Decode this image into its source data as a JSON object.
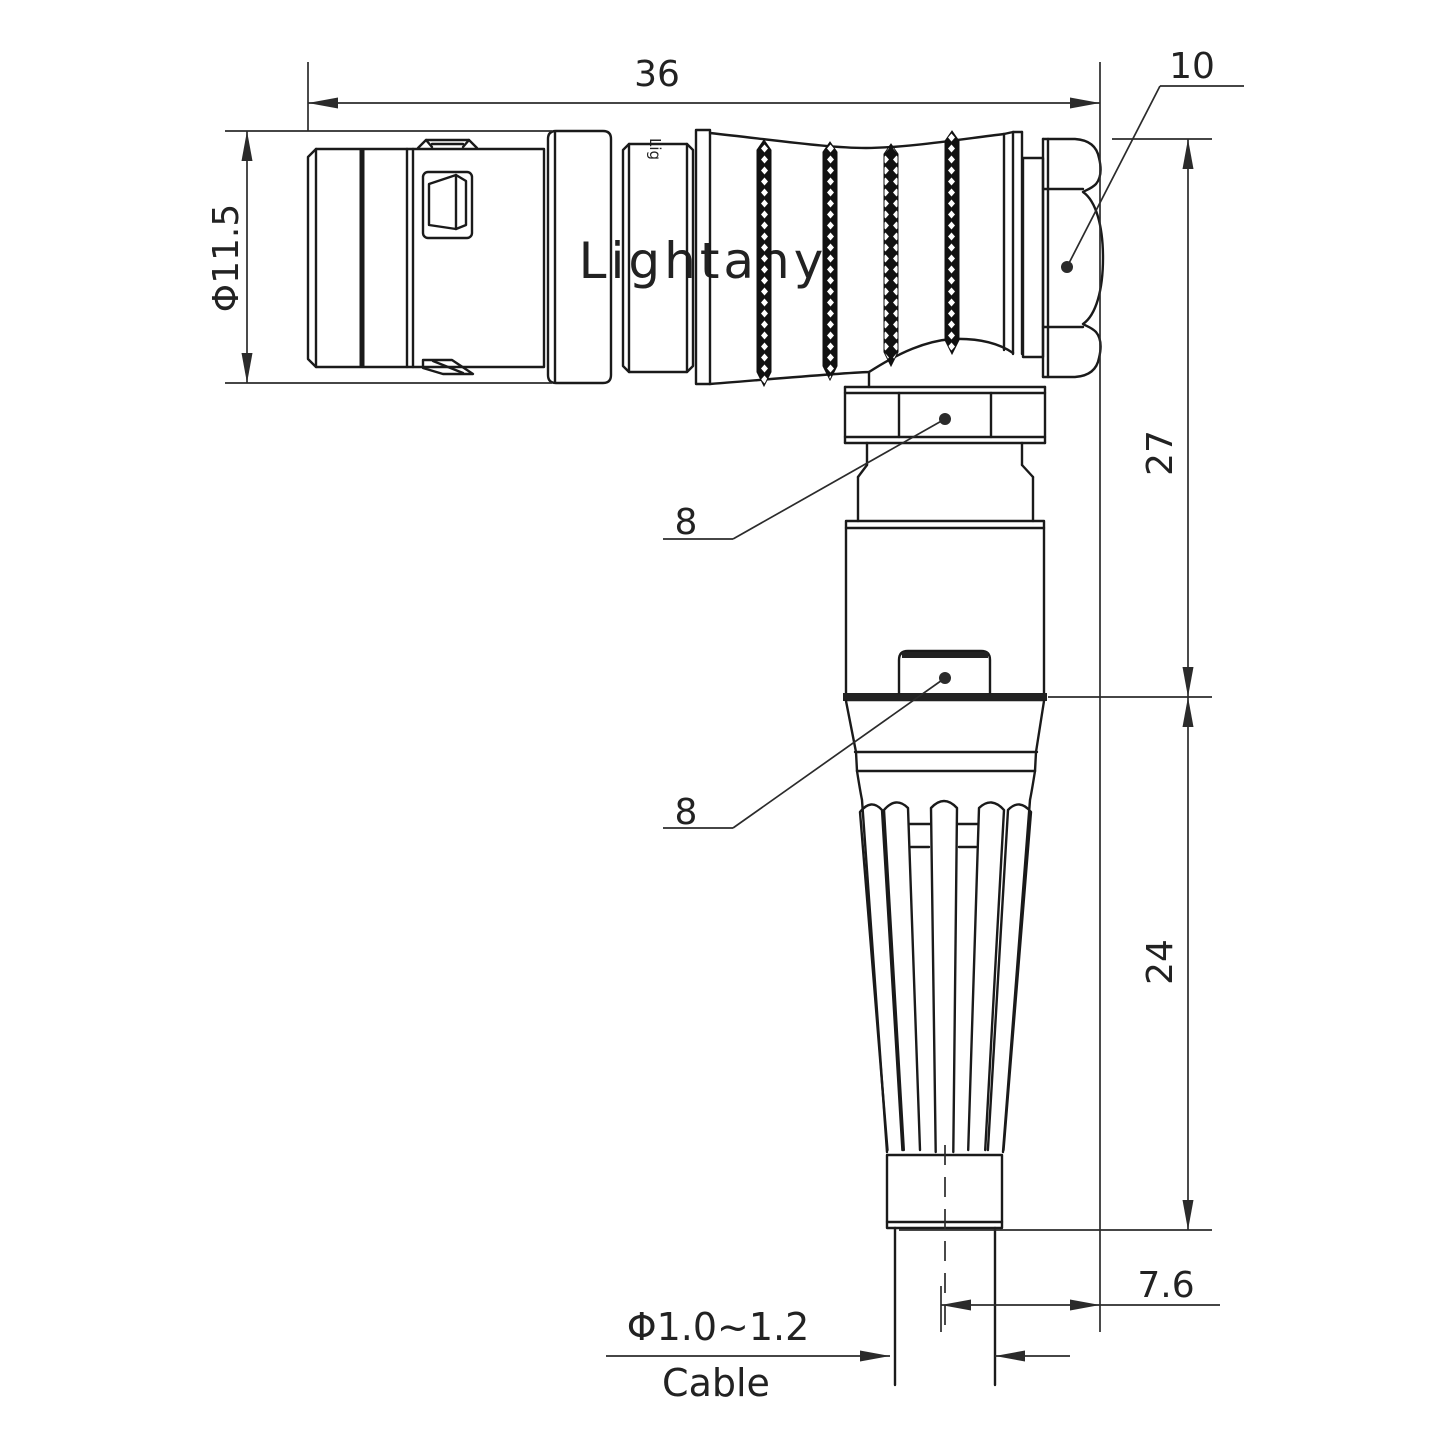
{
  "title": "right-angle-connector-technical-drawing",
  "watermark": {
    "text": "Lightany",
    "small_text": "Lig",
    "color": "#f3bdb8"
  },
  "dimensions": {
    "overall_length": "36",
    "nut_flat": "10",
    "shell_diameter": "Φ11.5",
    "upper_height": "27",
    "elbow_hex": "8",
    "body_hex": "8",
    "lower_height": "24",
    "cable_offset": "7.6",
    "cable_diameter": "Φ1.0~1.2",
    "cable_word": "Cable"
  },
  "colors": {
    "line": "#1a1a1a",
    "dimension": "#2b2b2b",
    "watermark": "#f3bdb8",
    "background": "#ffffff"
  }
}
